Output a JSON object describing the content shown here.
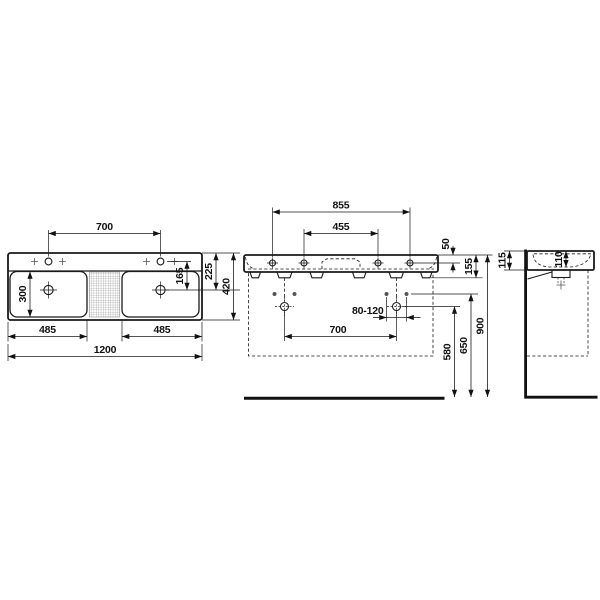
{
  "drawing": {
    "kind": "washbasin technical dimension drawing",
    "line_color": "#1a1a1a",
    "background_color": "#ffffff"
  },
  "plan_view": {
    "tap_hole_spacing": "700",
    "bowl_depth": "300",
    "tap_to_drain": "165",
    "rear_edge_to_drain": "225",
    "overall_depth": "420",
    "left_bowl_width": "485",
    "right_bowl_width": "485",
    "overall_width": "1200"
  },
  "front_view": {
    "outer_holes_spacing": "855",
    "inner_holes_spacing": "455",
    "rim_to_hole_line": "50",
    "body_height": "155",
    "drain_offset_range": "80-120",
    "fixing_holes_spacing": "700",
    "fixing_holes_height": "580",
    "supply_line_height": "650",
    "rim_height": "900"
  },
  "side_view": {
    "height_at_wall": "115",
    "inner_bowl_depth": "110"
  }
}
